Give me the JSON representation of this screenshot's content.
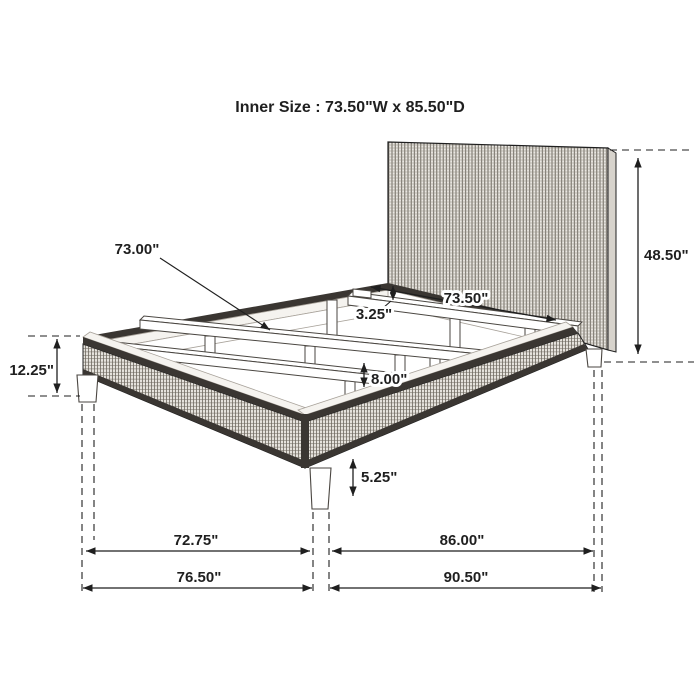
{
  "title": "Inner Size :  73.50\"W x 85.50\"D",
  "dims": {
    "slat_length": "73.00\"",
    "inner_width": "73.50\"",
    "slat_recess": "3.25\"",
    "headboard_height": "48.50\"",
    "platform_height": "12.25\"",
    "under_slat_clearance": "8.00\"",
    "leg_height": "5.25\"",
    "foot_between_legs": "72.75\"",
    "side_between_legs": "86.00\"",
    "overall_width": "76.50\"",
    "overall_depth": "90.50\""
  },
  "colors": {
    "ink": "#1f1f1f",
    "trim": "#3a3632",
    "weave_bg": "#e6e3dd",
    "weave_line": "#6e685f",
    "hb_bg": "#eae7e2",
    "hb_line": "#5f5a52",
    "hb_hline": "#8f897f",
    "band": "#f5f3ef",
    "face_line": "#4a4641",
    "inner_line": "#a8a29a",
    "paper": "#ffffff"
  }
}
